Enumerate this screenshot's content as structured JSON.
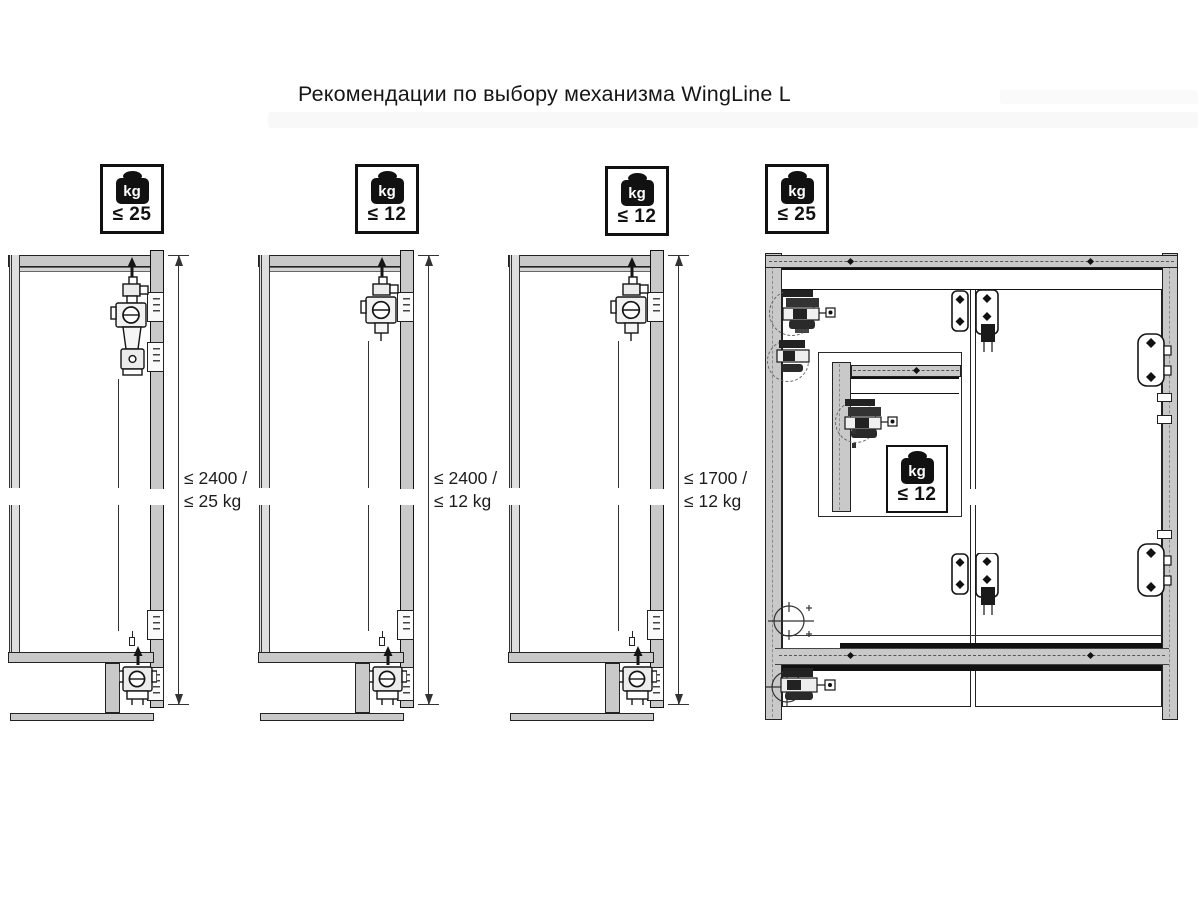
{
  "page": {
    "title": "Рекомендации по выбору механизма WingLine L"
  },
  "colors": {
    "panel_gray": "#c9c9c9",
    "outline": "#111111",
    "dash_line": "#777777"
  },
  "weight_badges": [
    {
      "id": "badge-door-1",
      "unit": "kg",
      "limit": "≤ 25"
    },
    {
      "id": "badge-door-2",
      "unit": "kg",
      "limit": "≤ 12"
    },
    {
      "id": "badge-door-3",
      "unit": "kg",
      "limit": "≤ 12"
    },
    {
      "id": "badge-cabinet",
      "unit": "kg",
      "limit": "≤ 25"
    },
    {
      "id": "badge-inset-detail",
      "unit": "kg",
      "limit": "≤ 12"
    }
  ],
  "dimension_labels": [
    {
      "line1": "≤ 2400 /",
      "line2": "≤ 25 kg"
    },
    {
      "line1": "≤ 2400 /",
      "line2": "≤ 12 kg"
    },
    {
      "line1": "≤ 1700 /",
      "line2": "≤ 12 kg"
    }
  ]
}
